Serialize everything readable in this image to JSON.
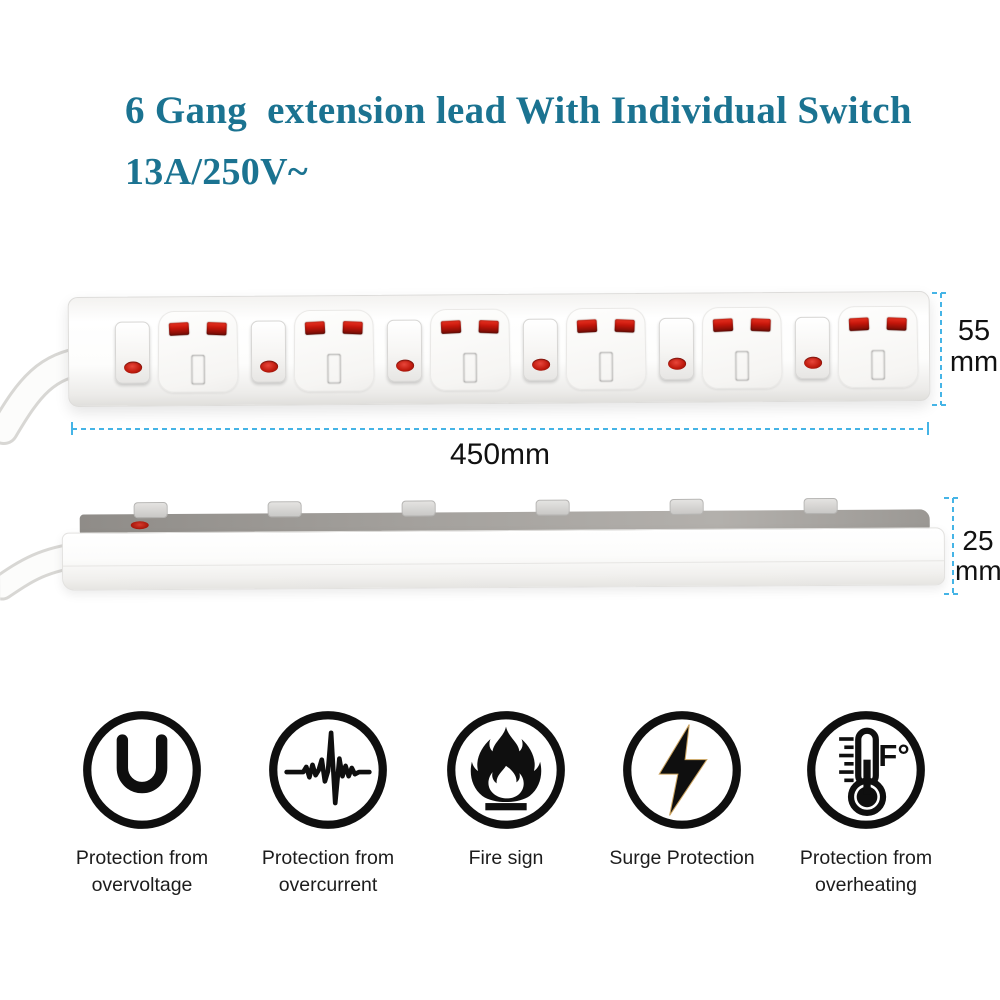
{
  "title": {
    "line1": "6 Gang  extension lead With Individual Switch",
    "line2": "13A/250V~",
    "color": "#1b7391"
  },
  "top_view": {
    "length_label": "450mm",
    "height_label": "55\nmm",
    "socket_count": 6
  },
  "side_view": {
    "thickness_label": "25\nmm",
    "switch_count": 6
  },
  "features": [
    {
      "icon": "overvoltage-protection-icon",
      "label": "Protection from overvoltage"
    },
    {
      "icon": "overcurrent-protection-icon",
      "label": "Protection from overcurrent"
    },
    {
      "icon": "fire-sign-icon",
      "label": "Fire sign"
    },
    {
      "icon": "surge-protection-icon",
      "label": "Surge Protection"
    },
    {
      "icon": "overheating-protection-icon",
      "label": "Protection from overheating"
    }
  ],
  "colors": {
    "accent_teal": "#1b7391",
    "dimension_cyan": "#45b4e6",
    "socket_red": "#c2150a",
    "icon_black": "#0f0f0f"
  }
}
